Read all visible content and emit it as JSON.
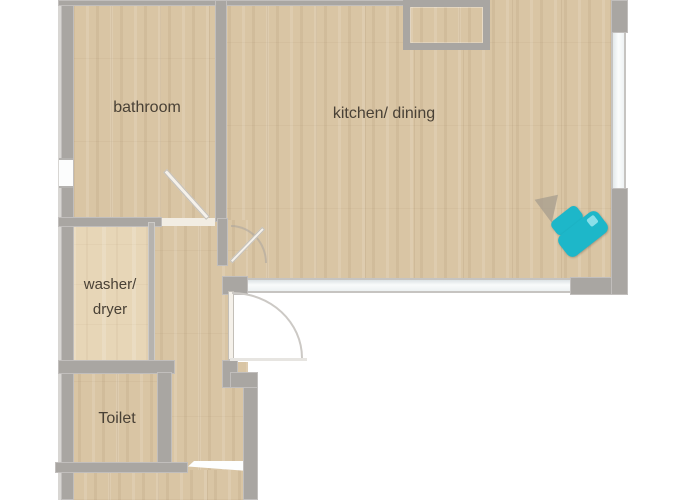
{
  "title": "apartment floor plan",
  "rooms": {
    "bathroom": {
      "label": "bathroom"
    },
    "kitchen_dining": {
      "label": "kitchen/ dining"
    },
    "washer_dryer": {
      "line1": "washer/",
      "line2": "dryer"
    },
    "toilet": {
      "label": "Toilet"
    }
  },
  "colors": {
    "background": "#ffffff",
    "floor_wood": "#d9c5a4",
    "floor_wood_light": "#e7d6b7",
    "wall_gray": "#a9a6a2",
    "window_white": "#f9fbfb",
    "label_text": "#494136",
    "marker_teal": "#1db7c9"
  },
  "markers": {
    "tour_marker": {
      "name": "3d-tour-position-marker",
      "color": "#1db7c9"
    }
  }
}
